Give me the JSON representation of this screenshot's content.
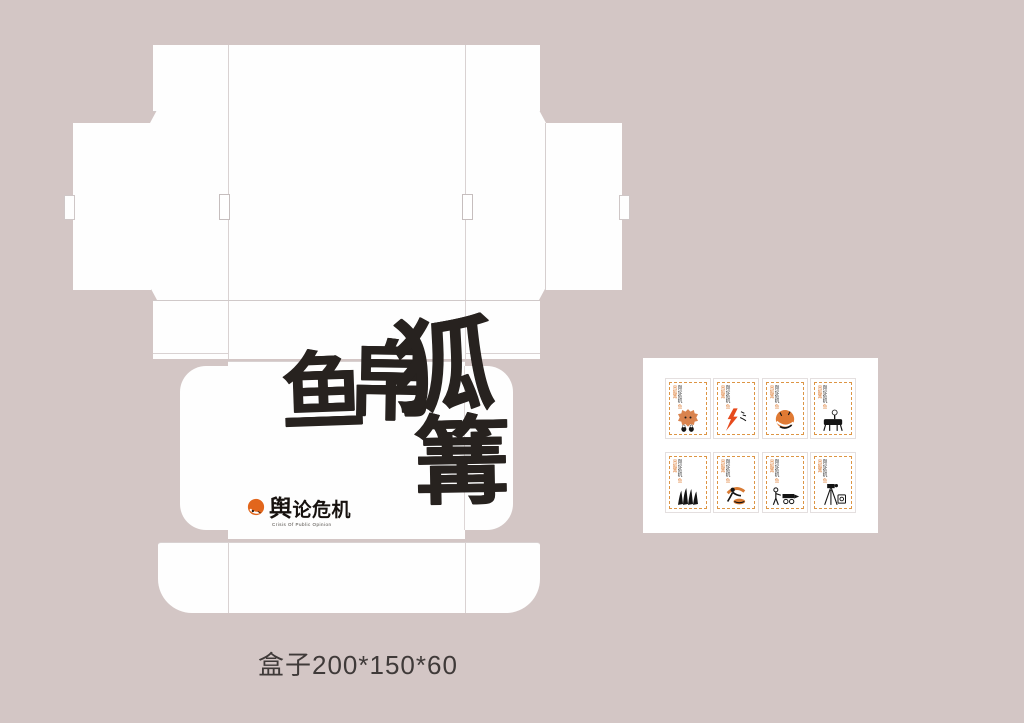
{
  "artboard": {
    "background": "#d3c6c5",
    "width": 1024,
    "height": 723
  },
  "caption": {
    "text": "盒子200*150*60",
    "color": "#3f3a39"
  },
  "dieline": {
    "panel_color": "#ffffff",
    "fold_line_color": "#d9d2d2",
    "box_face": {
      "calligraphy": {
        "text": "鱼帛狐篝",
        "char1": "鱼",
        "char2": "帛",
        "char3": "狐",
        "char4": "篝",
        "color": "#27221f"
      },
      "logo": {
        "name": "舆论危机",
        "tagline": "Crisis Of Public Opinion",
        "icon": "fox-circle-icon",
        "icon_color": "#e2661c",
        "text_color": "#17120f"
      }
    }
  },
  "sticker_sheet": {
    "background": "#ffffff",
    "card_border_color": "#dd9544",
    "card_label": {
      "primary": "舆论危机",
      "secondary": "鱼帛狐篝"
    },
    "cards": [
      {
        "illustration": "fox-head-with-figures"
      },
      {
        "illustration": "lightning-bolt-with-birds"
      },
      {
        "illustration": "curled-sleeping-fox"
      },
      {
        "illustration": "figure-at-black-desk"
      },
      {
        "illustration": "raised-black-hands"
      },
      {
        "illustration": "kneeling-figure-with-fox"
      },
      {
        "illustration": "stick-figure-with-camera-cart"
      },
      {
        "illustration": "camera-on-tripod"
      }
    ]
  }
}
